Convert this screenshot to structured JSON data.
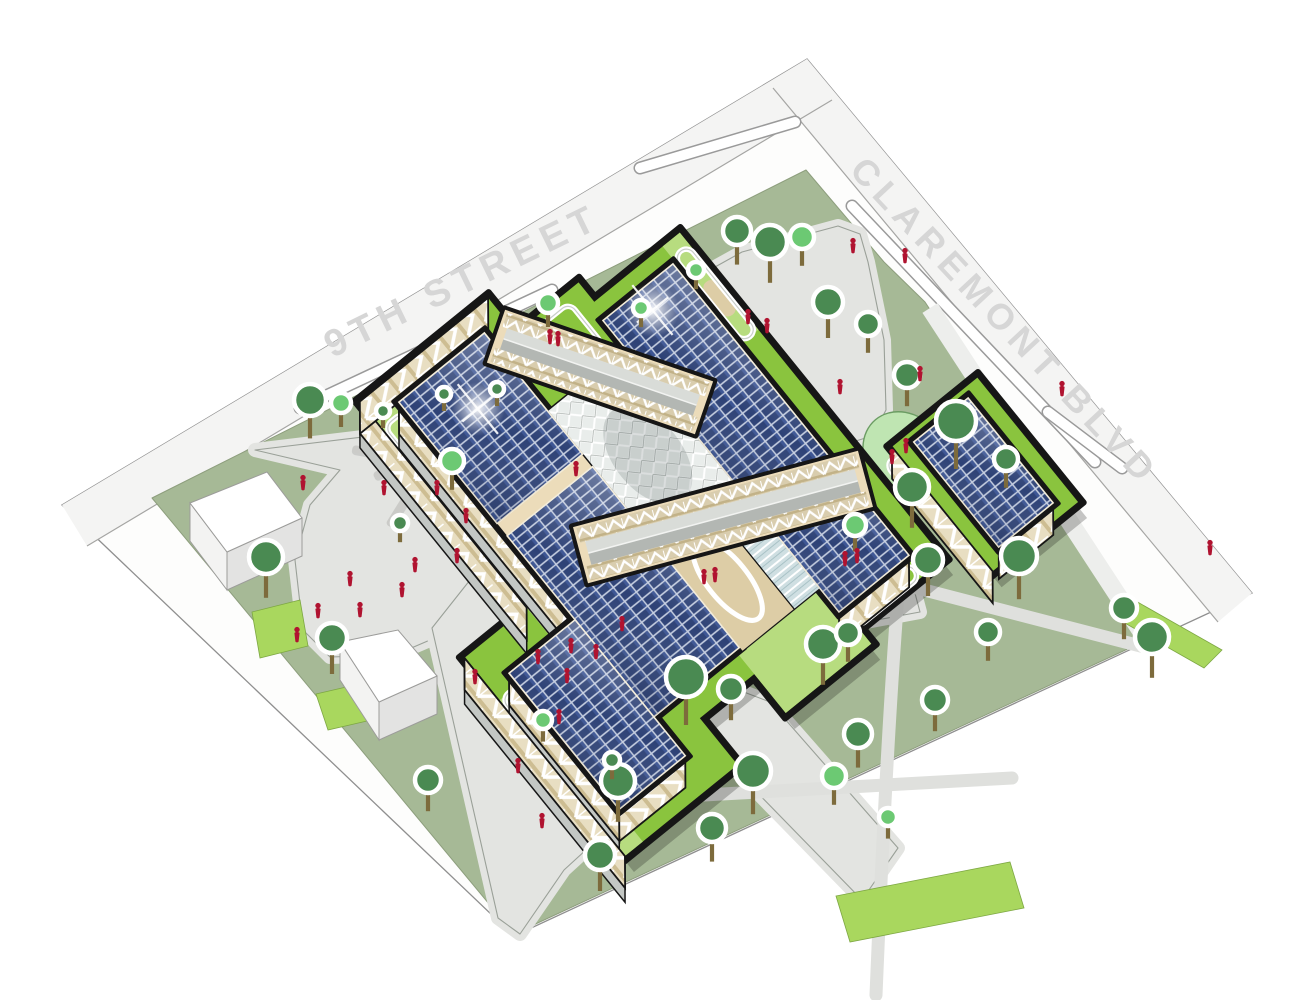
{
  "scene": {
    "width": 1304,
    "height": 1000
  },
  "streets": {
    "ninth": {
      "label": "9TH STREET",
      "x": 468,
      "y": 292,
      "angle": -26
    },
    "claremont": {
      "label": "CLAREMONT BLVD",
      "x": 996,
      "y": 330,
      "angle": 47
    },
    "outer_boundary": [
      [
        807,
        59
      ],
      [
        62,
        505
      ],
      [
        514,
        936
      ],
      [
        1252,
        593
      ]
    ],
    "far_band_nw": [
      [
        807,
        59
      ],
      [
        832,
        100
      ],
      [
        87,
        546
      ],
      [
        62,
        505
      ]
    ],
    "far_band_ne": [
      [
        807,
        59
      ],
      [
        773,
        88
      ],
      [
        1218,
        622
      ],
      [
        1252,
        593
      ]
    ],
    "sidewalk_lines": [
      [
        [
          832,
          100
        ],
        [
          87,
          546
        ]
      ],
      [
        [
          773,
          88
        ],
        [
          1218,
          622
        ]
      ]
    ],
    "medians": [
      "M300,408 L552,290",
      "M640,168 L795,122",
      "M852,206 L1095,462",
      "M1048,412 L1122,468"
    ]
  },
  "parcel": {
    "outline": [
      [
        806,
        170
      ],
      [
        884,
        262
      ],
      [
        925,
        302
      ],
      [
        1147,
        640
      ],
      [
        514,
        934
      ],
      [
        152,
        498
      ]
    ],
    "ne_sidewalk": [
      [
        930,
        308
      ],
      [
        1143,
        634
      ]
    ]
  },
  "hardscape": {
    "left_plaza": [
      [
        255,
        450
      ],
      [
        545,
        415
      ],
      [
        566,
        432
      ],
      [
        568,
        500
      ],
      [
        540,
        535
      ],
      [
        430,
        640
      ],
      [
        395,
        655
      ],
      [
        330,
        657
      ],
      [
        303,
        630
      ],
      [
        295,
        560
      ],
      [
        310,
        505
      ],
      [
        340,
        470
      ]
    ],
    "north_plaza": [
      [
        664,
        330
      ],
      [
        676,
        300
      ],
      [
        706,
        272
      ],
      [
        742,
        252
      ],
      [
        838,
        226
      ],
      [
        860,
        234
      ],
      [
        868,
        262
      ],
      [
        884,
        340
      ],
      [
        886,
        410
      ],
      [
        872,
        436
      ],
      [
        846,
        444
      ],
      [
        816,
        436
      ],
      [
        760,
        398
      ],
      [
        700,
        362
      ],
      [
        672,
        346
      ]
    ],
    "road": [
      [
        470,
        580
      ],
      [
        905,
        556
      ],
      [
        920,
        612
      ],
      [
        660,
        660
      ],
      [
        770,
        702
      ],
      [
        898,
        848
      ],
      [
        862,
        900
      ],
      [
        706,
        740
      ],
      [
        564,
        870
      ],
      [
        520,
        934
      ],
      [
        498,
        918
      ],
      [
        432,
        628
      ]
    ],
    "lawn_paths": [
      "M905,585 L1148,648",
      "M898,594 C890,700 882,850 876,995",
      "M650,798 L1012,778"
    ]
  },
  "accents": {
    "bright_patches": [
      [
        [
          252,
          612
        ],
        [
          300,
          600
        ],
        [
          308,
          646
        ],
        [
          260,
          658
        ]
      ],
      [
        [
          836,
          896
        ],
        [
          1010,
          862
        ],
        [
          1024,
          908
        ],
        [
          850,
          942
        ]
      ],
      [
        [
          1134,
          600
        ],
        [
          1222,
          650
        ],
        [
          1204,
          668
        ],
        [
          1116,
          618
        ]
      ],
      [
        [
          316,
          694
        ],
        [
          368,
          682
        ],
        [
          380,
          718
        ],
        [
          328,
          730
        ]
      ]
    ],
    "pond": {
      "cx": 905,
      "cy": 455,
      "rx": 46,
      "ry": 39,
      "angle": 50
    }
  },
  "logs": [
    {
      "x": 372,
      "y": 452,
      "a": 10
    },
    {
      "x": 392,
      "y": 468,
      "a": -25
    },
    {
      "x": 409,
      "y": 452,
      "a": 62
    },
    {
      "x": 425,
      "y": 470,
      "a": 15
    },
    {
      "x": 419,
      "y": 497,
      "a": 80
    },
    {
      "x": 447,
      "y": 455,
      "a": -42
    },
    {
      "x": 452,
      "y": 486,
      "a": 28
    },
    {
      "x": 436,
      "y": 511,
      "a": -70
    },
    {
      "x": 466,
      "y": 500,
      "a": 4
    },
    {
      "x": 471,
      "y": 470,
      "a": -30
    },
    {
      "x": 480,
      "y": 516,
      "a": 52
    },
    {
      "x": 399,
      "y": 509,
      "a": -58
    }
  ],
  "neighbor_buildings": [
    {
      "top": [
        [
          190,
          503
        ],
        [
          267,
          472
        ],
        [
          302,
          518
        ],
        [
          227,
          552
        ]
      ],
      "west": [
        [
          190,
          503
        ],
        [
          227,
          552
        ],
        [
          227,
          590
        ],
        [
          190,
          541
        ]
      ],
      "south": [
        [
          227,
          552
        ],
        [
          302,
          518
        ],
        [
          302,
          556
        ],
        [
          227,
          590
        ]
      ]
    },
    {
      "top": [
        [
          340,
          642
        ],
        [
          398,
          630
        ],
        [
          437,
          676
        ],
        [
          379,
          702
        ]
      ],
      "west": [
        [
          340,
          642
        ],
        [
          379,
          702
        ],
        [
          379,
          740
        ],
        [
          340,
          680
        ]
      ],
      "south": [
        [
          379,
          702
        ],
        [
          437,
          676
        ],
        [
          437,
          714
        ],
        [
          379,
          740
        ]
      ]
    }
  ],
  "building": {
    "center": [
      700,
      480
    ],
    "rotation": 51,
    "base_rects": [
      [
        -275,
        50,
        185,
        215
      ],
      [
        -205,
        -140,
        215,
        5
      ],
      [
        -10,
        150,
        245,
        295
      ],
      [
        95,
        -280,
        255,
        -170
      ],
      [
        -230,
        -30,
        -140,
        80
      ],
      [
        150,
        -30,
        235,
        80
      ]
    ],
    "light_rects": [
      [
        -275,
        186,
        30,
        215
      ],
      [
        150,
        -30,
        235,
        80
      ],
      [
        -205,
        -140,
        -80,
        -118
      ],
      [
        45,
        272,
        245,
        295
      ]
    ],
    "mass_rects": [
      [
        -250,
        75,
        155,
        185
      ],
      [
        -185,
        -115,
        190,
        -25
      ],
      [
        30,
        185,
        205,
        270
      ],
      [
        105,
        -260,
        240,
        -190
      ]
    ],
    "solar_fields": [
      [
        -250,
        75,
        -94,
        185
      ],
      [
        -78,
        75,
        155,
        185
      ],
      [
        -185,
        -115,
        83,
        -25
      ],
      [
        91,
        -115,
        190,
        -25
      ],
      [
        30,
        185,
        205,
        270
      ],
      [
        105,
        -260,
        240,
        -190
      ]
    ],
    "flares": [
      [
        -195,
        128
      ],
      [
        -162,
        -70
      ]
    ],
    "facades": [
      {
        "pts": [
          [
            -250,
            185
          ],
          [
            30,
            185
          ],
          [
            55,
            205
          ],
          [
            -225,
            205
          ]
        ],
        "deep": true
      },
      {
        "pts": [
          [
            30,
            270
          ],
          [
            205,
            270
          ],
          [
            230,
            290
          ],
          [
            55,
            290
          ]
        ],
        "deep": true
      },
      {
        "pts": [
          [
            205,
            185
          ],
          [
            205,
            270
          ],
          [
            230,
            290
          ],
          [
            230,
            205
          ]
        ],
        "deep": false
      },
      {
        "pts": [
          [
            190,
            -115
          ],
          [
            190,
            -25
          ],
          [
            215,
            -5
          ],
          [
            215,
            -95
          ]
        ],
        "deep": false
      },
      {
        "pts": [
          [
            240,
            -260
          ],
          [
            240,
            -190
          ],
          [
            265,
            -170
          ],
          [
            265,
            -240
          ]
        ],
        "deep": false
      },
      {
        "pts": [
          [
            -275,
            215
          ],
          [
            -10,
            215
          ],
          [
            15,
            235
          ],
          [
            -250,
            235
          ]
        ],
        "deep": true
      },
      {
        "pts": [
          [
            -10,
            295
          ],
          [
            245,
            295
          ],
          [
            270,
            315
          ],
          [
            15,
            315
          ]
        ],
        "deep": true
      },
      {
        "pts": [
          [
            95,
            -170
          ],
          [
            255,
            -170
          ],
          [
            280,
            -150
          ],
          [
            120,
            -150
          ]
        ],
        "deep": false
      },
      {
        "pts": [
          [
            -275,
            50
          ],
          [
            -275,
            215
          ],
          [
            -250,
            235
          ],
          [
            -250,
            70
          ]
        ],
        "deep": false
      }
    ],
    "courtyard": {
      "diagrid": [
        -150,
        -25,
        28,
        75
      ],
      "glass": [
        30,
        -25,
        160,
        8
      ],
      "terrace": [
        30,
        8,
        160,
        75
      ]
    },
    "loops": [
      [
        -240,
        188,
        -130,
        212
      ],
      [
        -190,
        -138,
        -80,
        -120
      ],
      [
        196,
        -110,
        214,
        -30
      ],
      [
        45,
        272,
        180,
        292
      ],
      [
        -60,
        190,
        20,
        212
      ],
      [
        105,
        -168,
        230,
        -154
      ],
      [
        -220,
        -10,
        -165,
        55
      ]
    ],
    "tans": [
      [
        -210,
        189,
        -158,
        209
      ],
      [
        -150,
        -137,
        -108,
        -122
      ]
    ],
    "bridges": [
      {
        "cx": 600,
        "cy": 372,
        "angle": 19,
        "len": 220,
        "w": 56
      },
      {
        "cx": 723,
        "cy": 517,
        "angle": -15,
        "len": 295,
        "w": 58
      }
    ]
  },
  "trees": [
    {
      "x": 310,
      "y": 400,
      "r": 16,
      "shade": "dark"
    },
    {
      "x": 341,
      "y": 403,
      "r": 10,
      "shade": "light"
    },
    {
      "x": 383,
      "y": 411,
      "r": 7,
      "shade": "dark"
    },
    {
      "x": 444,
      "y": 394,
      "r": 7,
      "shade": "dark"
    },
    {
      "x": 497,
      "y": 389,
      "r": 7,
      "shade": "dark"
    },
    {
      "x": 266,
      "y": 557,
      "r": 17,
      "shade": "dark"
    },
    {
      "x": 332,
      "y": 638,
      "r": 15,
      "shade": "dark"
    },
    {
      "x": 400,
      "y": 523,
      "r": 8,
      "shade": "dark"
    },
    {
      "x": 428,
      "y": 780,
      "r": 13,
      "shade": "dark"
    },
    {
      "x": 737,
      "y": 231,
      "r": 14,
      "shade": "dark"
    },
    {
      "x": 770,
      "y": 242,
      "r": 17,
      "shade": "dark"
    },
    {
      "x": 802,
      "y": 237,
      "r": 12,
      "shade": "light"
    },
    {
      "x": 696,
      "y": 270,
      "r": 8,
      "shade": "light"
    },
    {
      "x": 828,
      "y": 302,
      "r": 15,
      "shade": "dark"
    },
    {
      "x": 868,
      "y": 324,
      "r": 12,
      "shade": "dark"
    },
    {
      "x": 907,
      "y": 375,
      "r": 13,
      "shade": "dark"
    },
    {
      "x": 956,
      "y": 421,
      "r": 20,
      "shade": "dark"
    },
    {
      "x": 1006,
      "y": 459,
      "r": 12,
      "shade": "dark"
    },
    {
      "x": 912,
      "y": 487,
      "r": 17,
      "shade": "dark"
    },
    {
      "x": 855,
      "y": 525,
      "r": 11,
      "shade": "light"
    },
    {
      "x": 1019,
      "y": 556,
      "r": 18,
      "shade": "dark"
    },
    {
      "x": 1124,
      "y": 608,
      "r": 13,
      "shade": "dark"
    },
    {
      "x": 1152,
      "y": 637,
      "r": 17,
      "shade": "dark"
    },
    {
      "x": 928,
      "y": 560,
      "r": 15,
      "shade": "dark"
    },
    {
      "x": 988,
      "y": 632,
      "r": 12,
      "shade": "dark"
    },
    {
      "x": 935,
      "y": 700,
      "r": 13,
      "shade": "dark"
    },
    {
      "x": 686,
      "y": 677,
      "r": 20,
      "shade": "dark"
    },
    {
      "x": 731,
      "y": 689,
      "r": 13,
      "shade": "dark"
    },
    {
      "x": 823,
      "y": 644,
      "r": 17,
      "shade": "dark"
    },
    {
      "x": 848,
      "y": 633,
      "r": 12,
      "shade": "dark"
    },
    {
      "x": 858,
      "y": 734,
      "r": 14,
      "shade": "dark"
    },
    {
      "x": 753,
      "y": 771,
      "r": 18,
      "shade": "dark"
    },
    {
      "x": 618,
      "y": 781,
      "r": 17,
      "shade": "dark"
    },
    {
      "x": 600,
      "y": 855,
      "r": 15,
      "shade": "dark"
    },
    {
      "x": 712,
      "y": 828,
      "r": 14,
      "shade": "dark"
    },
    {
      "x": 452,
      "y": 461,
      "r": 12,
      "shade": "light"
    },
    {
      "x": 543,
      "y": 720,
      "r": 9,
      "shade": "light"
    },
    {
      "x": 612,
      "y": 760,
      "r": 8,
      "shade": "dark"
    },
    {
      "x": 834,
      "y": 776,
      "r": 12,
      "shade": "light"
    },
    {
      "x": 888,
      "y": 817,
      "r": 9,
      "shade": "light"
    },
    {
      "x": 548,
      "y": 303,
      "r": 10,
      "shade": "light"
    },
    {
      "x": 641,
      "y": 308,
      "r": 8,
      "shade": "light"
    }
  ],
  "people": [
    {
      "x": 303,
      "y": 484
    },
    {
      "x": 350,
      "y": 580
    },
    {
      "x": 318,
      "y": 612
    },
    {
      "x": 360,
      "y": 611
    },
    {
      "x": 297,
      "y": 636
    },
    {
      "x": 415,
      "y": 566
    },
    {
      "x": 402,
      "y": 591
    },
    {
      "x": 457,
      "y": 557
    },
    {
      "x": 437,
      "y": 489
    },
    {
      "x": 475,
      "y": 678
    },
    {
      "x": 538,
      "y": 658
    },
    {
      "x": 567,
      "y": 677
    },
    {
      "x": 559,
      "y": 718
    },
    {
      "x": 518,
      "y": 767
    },
    {
      "x": 542,
      "y": 822
    },
    {
      "x": 571,
      "y": 647
    },
    {
      "x": 596,
      "y": 653
    },
    {
      "x": 622,
      "y": 625
    },
    {
      "x": 704,
      "y": 578
    },
    {
      "x": 715,
      "y": 576
    },
    {
      "x": 845,
      "y": 560
    },
    {
      "x": 857,
      "y": 557
    },
    {
      "x": 576,
      "y": 470
    },
    {
      "x": 466,
      "y": 517
    },
    {
      "x": 384,
      "y": 489
    },
    {
      "x": 550,
      "y": 338
    },
    {
      "x": 558,
      "y": 340
    },
    {
      "x": 748,
      "y": 318
    },
    {
      "x": 767,
      "y": 327
    },
    {
      "x": 920,
      "y": 375
    },
    {
      "x": 840,
      "y": 388
    },
    {
      "x": 892,
      "y": 458
    },
    {
      "x": 906,
      "y": 447
    },
    {
      "x": 1062,
      "y": 390
    },
    {
      "x": 1210,
      "y": 549
    },
    {
      "x": 853,
      "y": 247
    },
    {
      "x": 905,
      "y": 257
    }
  ],
  "colors": {
    "road_white": "#fdfdfc",
    "road_band": "#f4f4f3",
    "boundary_line": "#8f8f8f",
    "street_text": "#d6d6d6",
    "sage": "#a6b996",
    "sage_stroke": "#8d9e7d",
    "plaza": "#e3e4e1",
    "plaza_stroke": "#9aa098",
    "path_gray": "#dfe0dd",
    "sidewalk": "#edeeec",
    "accent_green": "#a9d75e",
    "accent_stroke": "#7da743",
    "pond_fill": "#bfe5b2",
    "pond_stroke": "#6b9c63",
    "tree_dark": "#4a8a52",
    "tree_light": "#6cc973",
    "tree_ring": "#ffffff",
    "trunk": "#7d6b3c",
    "person_red": "#b01330",
    "log_gray": "#cbcbc8",
    "box_top": "#ffffff",
    "box_west": "#f3f3f2",
    "box_south": "#e3e3e2",
    "box_stroke": "#9c9c9a",
    "outline_black": "#161616",
    "beige": "#ecdcba",
    "beige_dark": "#d9c596",
    "green_roof": "#8ac43e",
    "green_roof_light": "#b7dc7f",
    "tan": "#ddcda6",
    "solar_cell": "#2e4276",
    "solar_grid": "#c7d0e2",
    "louver": "#c3c7c4",
    "bridge_roof_light": "#d9dcd8",
    "bridge_roof_dark": "#b3b7b3",
    "path_loop": "#ffffff"
  }
}
